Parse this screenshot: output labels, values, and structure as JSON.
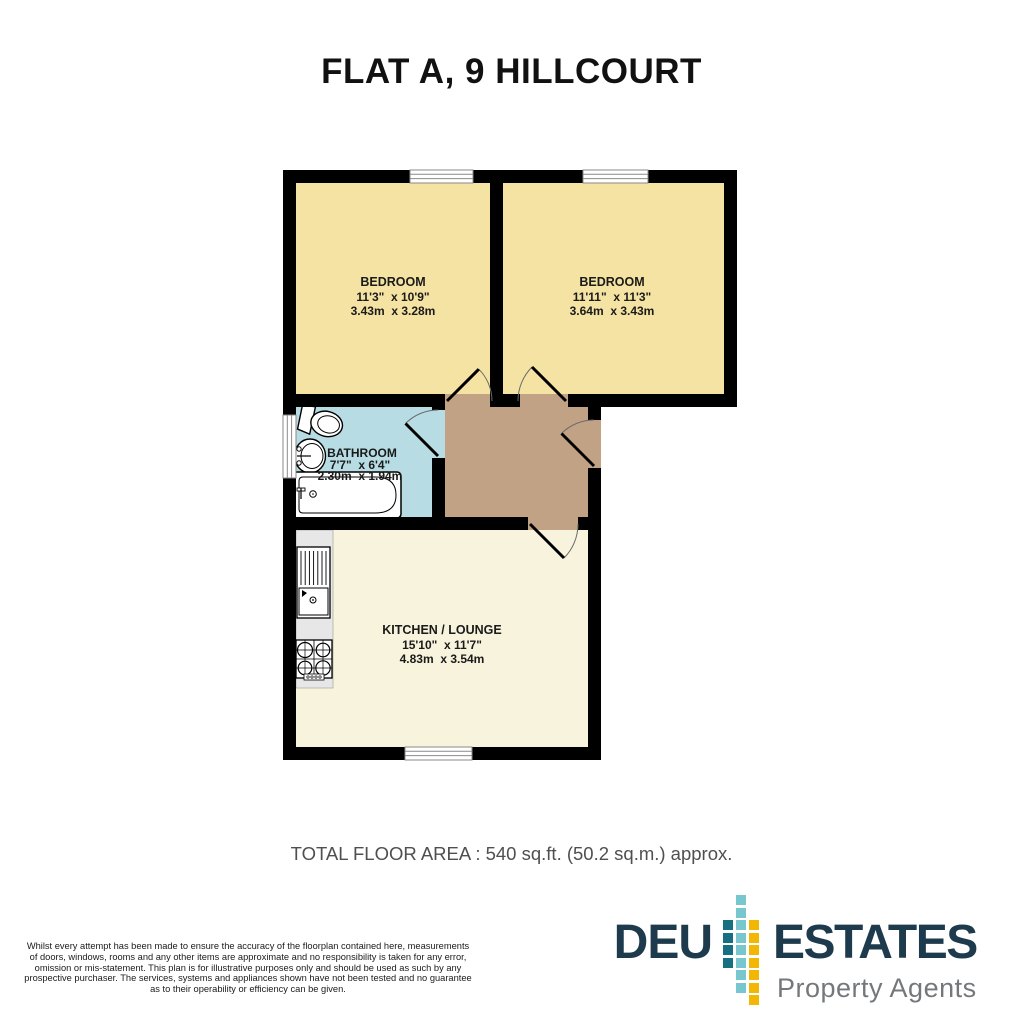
{
  "title": "FLAT A, 9 HILLCOURT",
  "rooms": {
    "bedroom1": {
      "name": "BEDROOM",
      "imperial": "11'3\"  x 10'9\"",
      "metric": "3.43m  x 3.28m"
    },
    "bedroom2": {
      "name": "BEDROOM",
      "imperial": "11'11\"  x 11'3\"",
      "metric": "3.64m  x 3.43m"
    },
    "bathroom": {
      "name": "BATHROOM",
      "imperial": "7'7\"  x 6'4\"",
      "metric": "2.30m  x 1.94m"
    },
    "kitchen": {
      "name": "KITCHEN / LOUNGE",
      "imperial": "15'10\"  x 11'7\"",
      "metric": "4.83m  x 3.54m"
    }
  },
  "summary": {
    "total_area": "TOTAL FLOOR AREA : 540 sq.ft. (50.2 sq.m.) approx."
  },
  "disclaimer": {
    "line1": "Whilst every attempt has been made to ensure the accuracy of the floorplan contained here, measurements",
    "line2": "of doors, windows, rooms and any other items are approximate and no responsibility is taken for any error,",
    "line3": "omission or mis-statement. This plan is for illustrative purposes only and should be used as such by any",
    "line4": "prospective purchaser. The services, systems and appliances shown have not been tested and no guarantee",
    "line5": "as to their operability or efficiency can be given."
  },
  "logo": {
    "name": "DEU",
    "name2": "ESTATES",
    "tagline": "Property Agents",
    "colors": {
      "navy": "#1e3a4d",
      "teal_dark": "#177082",
      "teal_light": "#79c7ce",
      "gold": "#f2b705",
      "gray": "#75787b"
    }
  },
  "colors": {
    "bedroom": "#f4e3a3",
    "bathroom": "#b8dce4",
    "hallway": "#c2a284",
    "kitchen": "#f8f3dc",
    "wall": "#000000",
    "counter": "#e7e7e7"
  }
}
